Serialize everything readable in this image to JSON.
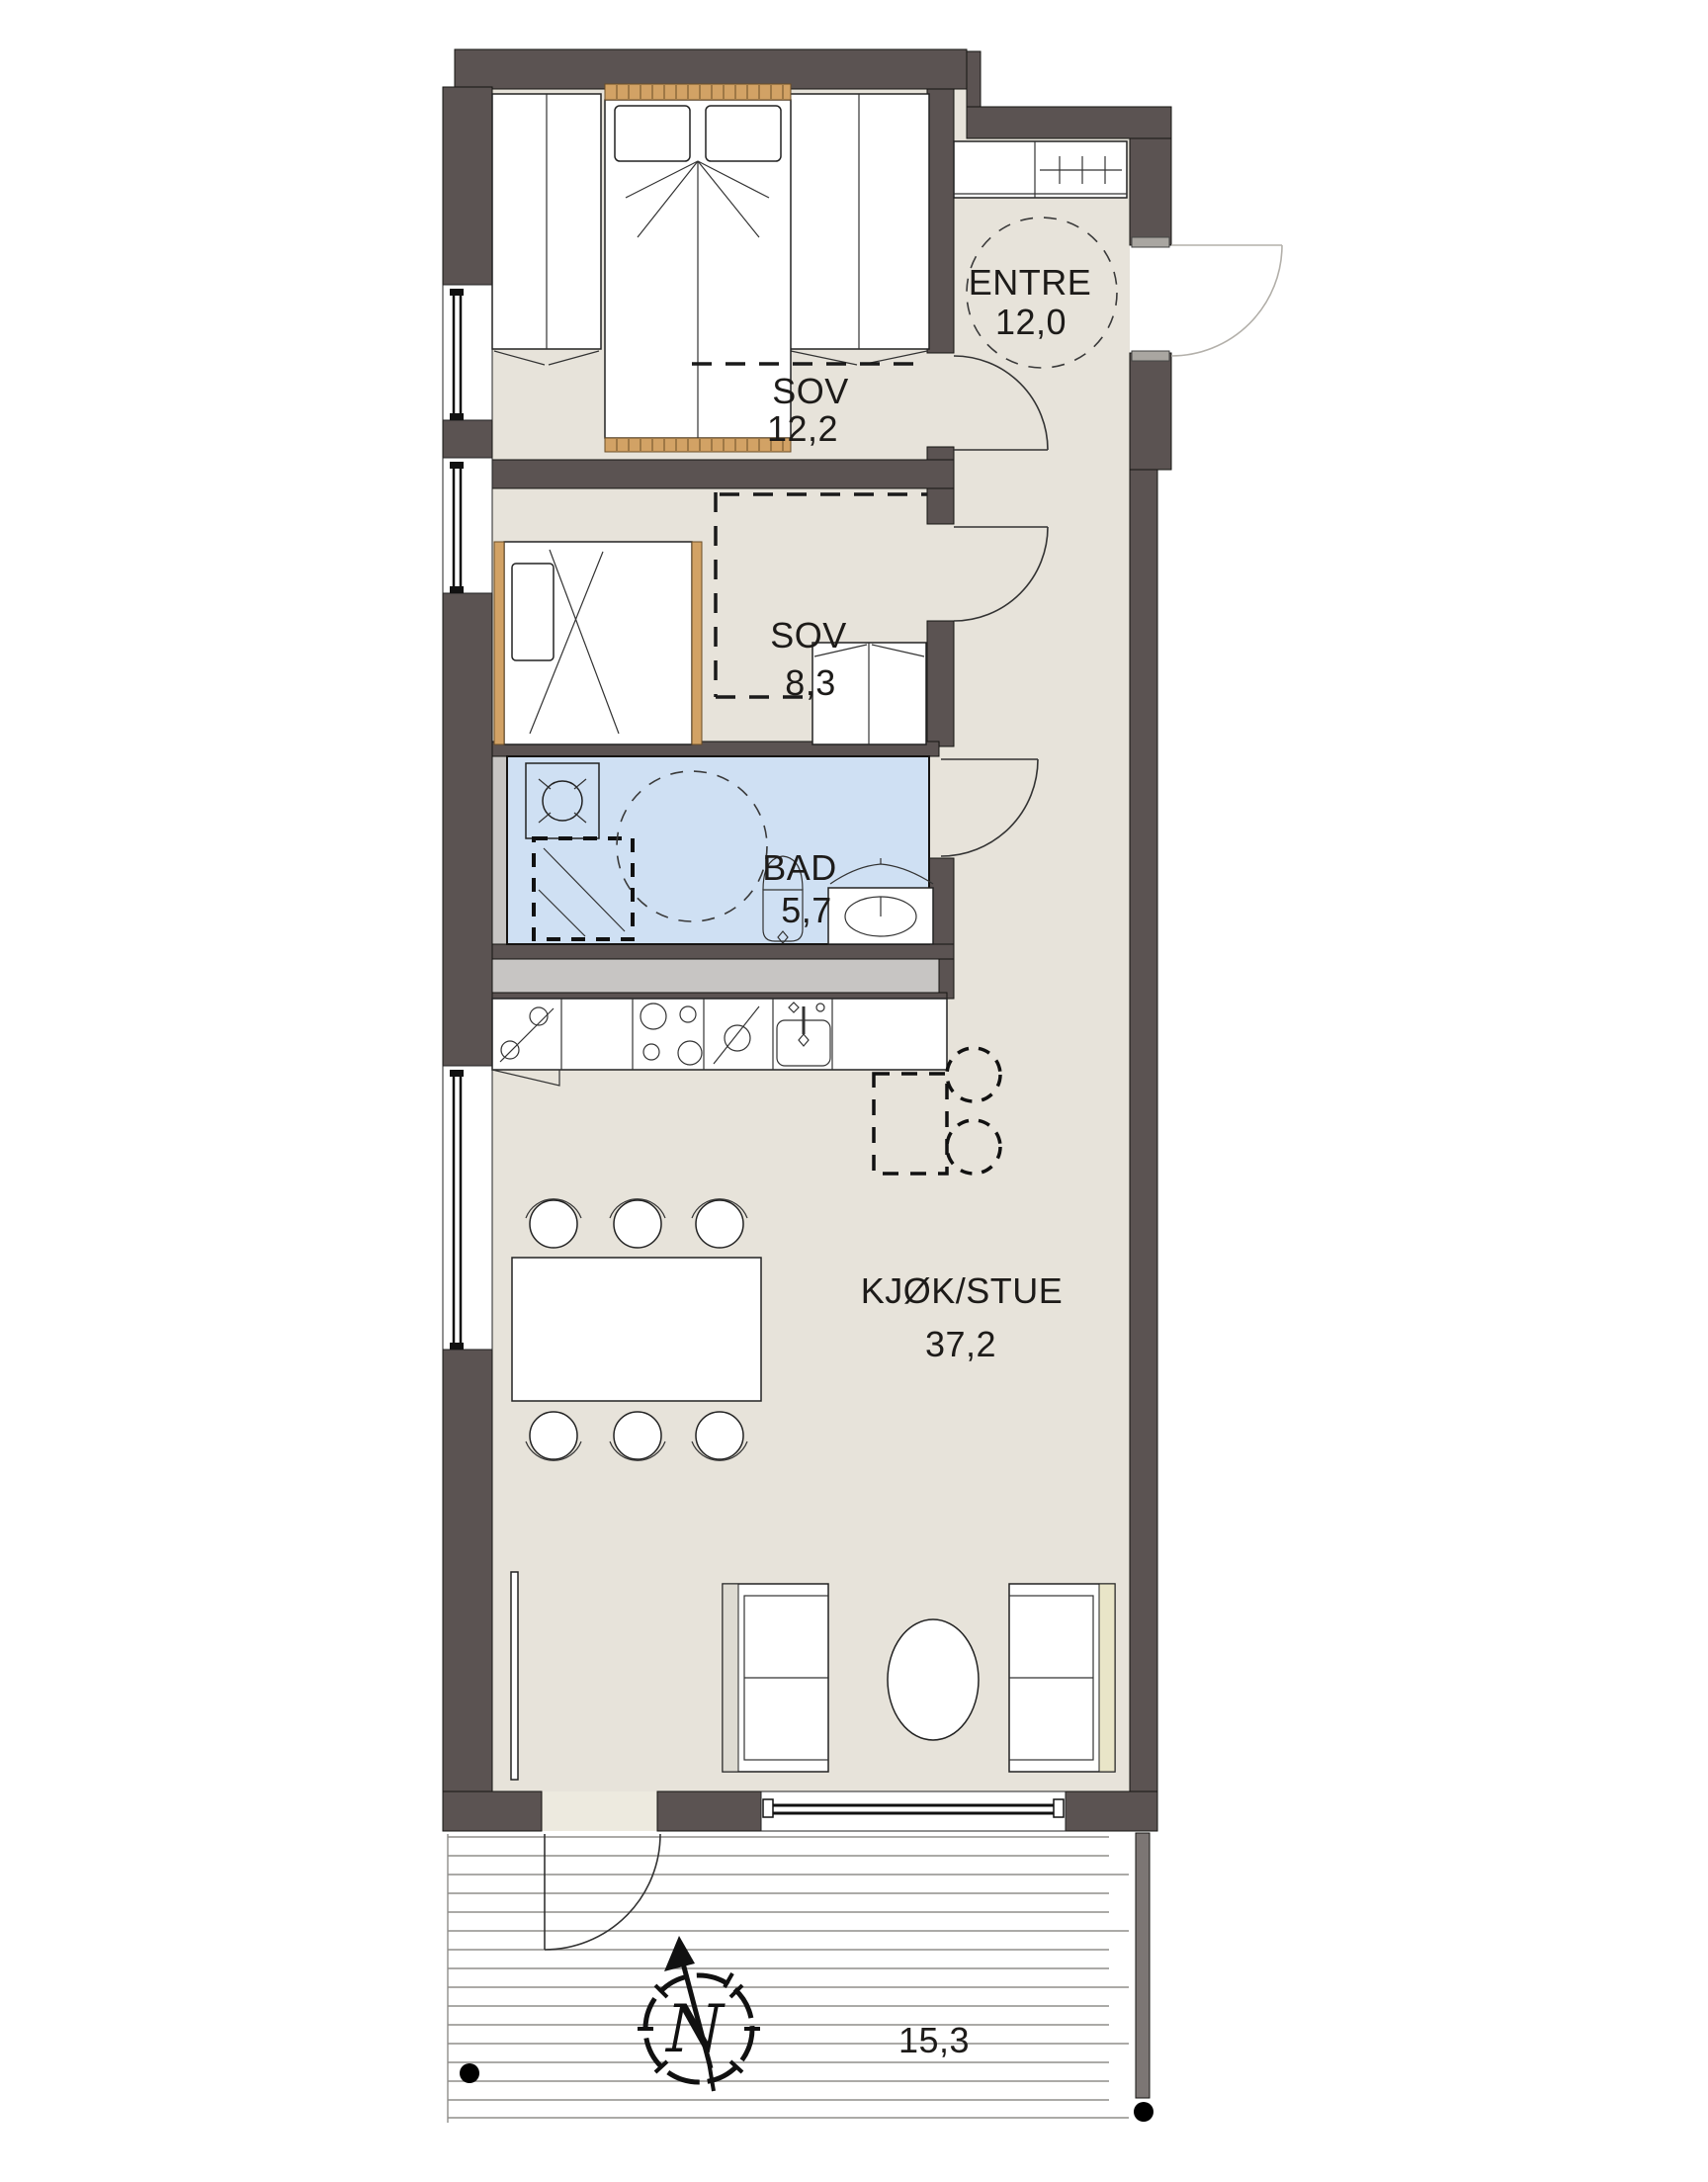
{
  "plan": {
    "title": "apartment-floor-plan",
    "rooms": [
      {
        "id": "entre",
        "name": "ENTRE",
        "area": "12,0"
      },
      {
        "id": "sov-1",
        "name": "SOV",
        "area": "12,2"
      },
      {
        "id": "sov-2",
        "name": "SOV",
        "area": "8,3"
      },
      {
        "id": "bad",
        "name": "BAD",
        "area": "5,7"
      },
      {
        "id": "kjok-stue",
        "name": "KJØK/STUE",
        "area": "37,2"
      }
    ],
    "terrace": {
      "dimension": "15,3"
    },
    "compass": {
      "label": "N"
    },
    "colors": {
      "wall": "#5b5352",
      "floor": "#e7e3da",
      "bath_floor": "#cfe0f3",
      "wood": "#d2a265",
      "shaft_gray": "#c7c5c3",
      "deck_line": "#8f8d8a"
    },
    "icons": [
      "double-bed-icon",
      "single-bed-icon",
      "wardrobe-icon",
      "washing-machine-icon",
      "shower-icon",
      "toilet-icon",
      "vanity-sink-icon",
      "fridge-icon",
      "cooktop-icon",
      "dishwasher-icon",
      "kitchen-sink-icon",
      "dining-table-icon",
      "chair-icon",
      "sofa-icon",
      "coffee-table-icon",
      "island-dashed-icon",
      "turning-circle-icon",
      "north-compass-icon",
      "door-swing-icon"
    ]
  }
}
